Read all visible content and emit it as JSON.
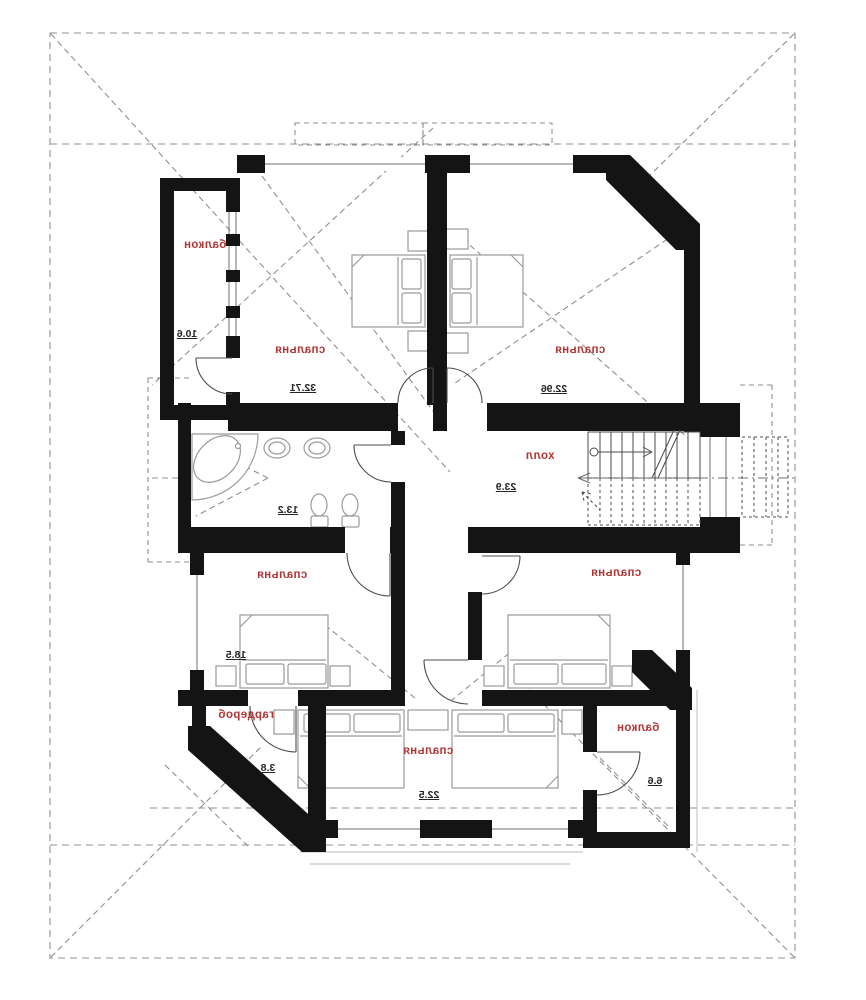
{
  "plan": {
    "type": "floor-plan",
    "language": "ru",
    "mirrored_text": true,
    "rooms": [
      {
        "id": "balcony-top",
        "label": "балкон",
        "area": "10.6"
      },
      {
        "id": "bedroom-top-left",
        "label": "спальня",
        "area": "32.71"
      },
      {
        "id": "bedroom-top-right",
        "label": "спальня",
        "area": "22.96"
      },
      {
        "id": "hall",
        "label": "холл",
        "area": "23.9"
      },
      {
        "id": "bathroom",
        "label": "",
        "area": "13.2"
      },
      {
        "id": "bedroom-mid-left",
        "label": "спальня",
        "area": "18.5"
      },
      {
        "id": "bedroom-mid-right",
        "label": "спальня",
        "area": ""
      },
      {
        "id": "wardrobe",
        "label": "гардероб",
        "area": "3.8"
      },
      {
        "id": "bedroom-bottom",
        "label": "спальня",
        "area": "22.5"
      },
      {
        "id": "balcony-bottom",
        "label": "балкон",
        "area": "6.6"
      }
    ],
    "colors": {
      "room_label": "#b23535",
      "area_number": "#262626",
      "wall": "#141414",
      "roof_dash": "#8f8f8f"
    }
  }
}
